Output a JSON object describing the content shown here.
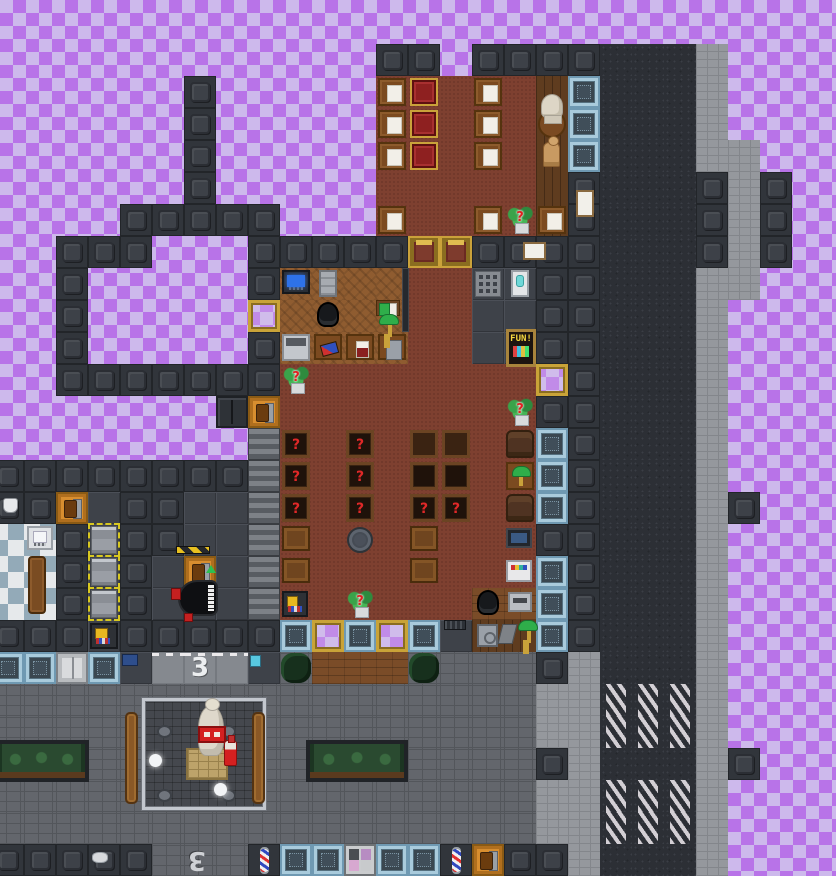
{
  "meta": {
    "description": "Top-down 2D space-station tile map (library, barbershop, statue plaza, road with crosswalks) over a purple transparency checkerboard",
    "grid": {
      "tile": 32,
      "cols": 27,
      "rows": 27,
      "offset_x": -8,
      "offset_y": 12
    }
  },
  "palette": {
    "checker_dark": "#b873e8",
    "checker_light": "#cdb9ec",
    "wall": "#31353b",
    "plating": "#3e4249",
    "red_floor": "#7e4030",
    "parquet": "#8f5c30",
    "porch": "#7a4c28",
    "sidewalk": "#95989d",
    "cobble": "#63666c",
    "asphalt": "#2c2f35",
    "crosswalk_stripe": "#d3cfd4",
    "window_frame_blue": "#a9cbdc",
    "gold": "#c9a23a",
    "airlock_orange": "#d88e2f",
    "question_red": "#e02020",
    "lamp_green": "#2fae4a",
    "barber_red": "#e03030",
    "barber_blue": "#3048c0"
  },
  "map": {
    "legend": {
      "#": {
        "cls": "wall",
        "name": "wall-tile",
        "inter": false
      },
      "Z": {
        "cls": "shutter",
        "name": "window-shutters",
        "inter": true
      },
      "R": {
        "cls": "redfloor",
        "name": "red-wood-floor",
        "inter": false
      },
      "P": {
        "cls": "parquet",
        "name": "parquet-floor",
        "inter": false
      },
      "H": {
        "cls": "woodv",
        "name": "dark-wood-floor",
        "inter": false
      },
      "p": {
        "cls": "porch",
        "name": "wood-deck-floor",
        "inter": false
      },
      "F": {
        "cls": "plating",
        "name": "plating-floor",
        "inter": false
      },
      "T": {
        "cls": "bath",
        "name": "checker-tile-floor",
        "inter": false
      },
      "S": {
        "cls": "side",
        "name": "sidewalk",
        "inter": false
      },
      "C": {
        "cls": "cobble",
        "name": "pavement",
        "inter": false
      },
      "A": {
        "cls": "asphalt",
        "name": "road",
        "inter": false
      },
      "X": {
        "cls": "cross",
        "name": "crosswalk",
        "inter": false
      },
      "L": {
        "cls": "lroad",
        "name": "road-lane",
        "inter": false
      },
      "B": {
        "cls": "bwin",
        "name": "reinforced-window",
        "inter": true
      },
      "G": {
        "cls": "gwin",
        "name": "gold-framed-window",
        "inter": true
      },
      "Y": {
        "cls": "ydoor",
        "name": "gold-glass-door",
        "inter": true
      },
      "O": {
        "cls": "odoor",
        "name": "orange-airlock",
        "inter": true
      },
      "W": {
        "cls": "wdoor",
        "name": "white-airlock",
        "inter": true
      },
      "d": {
        "cls": "ddoor",
        "name": "dark-double-door",
        "inter": true
      },
      "s": {
        "cls": "sdoor",
        "name": "salon-door",
        "inter": true
      },
      "b": {
        "cls": "barber",
        "name": "barber-pole-wall",
        "inter": false
      }
    },
    "rows": [
      "...........................",
      "............##.####AAAS....",
      "......#.....RRRRRHBAAAS....",
      "......#.....RRRRRHBAAAS....",
      "......#.....RRRRRHBAAASS...",
      "......#.....RRRRRH#AAA#S#..",
      "....#####...RRRRRH#AAA#S#..",
      "..###...#####YY####AAA#S#..",
      "..#.....#PPPPRRFF##AAASS...",
      "..#.....GPPPPRRFF##AAAS....",
      "..#.....#PPPPRRFF##AAAS....",
      "..#######RRRRRRRRG#AAAS....",
      ".......dORRRRRRRR##AAAS....",
      "........ZRRRRRRRRB#AAAS....",
      "########ZRRRRRRRRB#AAAS....",
      "##OF##FFZRRRRRRRRB#AAAS#...",
      "TT#F##FFZRRRRRRRR##AAAS....",
      "TT#F#FOFZRRRRRRRRB#AAAS....",
      "TT#F#FFFZRRRRRRppB#AAAS....",
      "###F#####BGBGBFHHB#AAAS....",
      "BBWBFLLLFCpppCCCC#SAAAS....",
      "CCCCCCCCCCCCCCCCCSSXXXS....",
      "CCCCCCCCCCCCCCCCCSSXXXS....",
      "CCCCCCCCCCCCCCCCC#SAAAS#...",
      "CCCCCCCCCCCCCCCCCSSXXXS....",
      "CCCCCCCCCCCCCCCCCSSXXXS....",
      "#####CCCbBBsBBbO##SAAAS...."
    ]
  },
  "objects": [
    {
      "type": "paper-table",
      "name": "table-with-paper",
      "col": 12,
      "row": 2
    },
    {
      "type": "paper-table",
      "name": "table-with-paper",
      "col": 12,
      "row": 3
    },
    {
      "type": "paper-table",
      "name": "table-with-paper",
      "col": 12,
      "row": 4
    },
    {
      "type": "paper-table",
      "name": "table-with-paper",
      "col": 15,
      "row": 2
    },
    {
      "type": "paper-table",
      "name": "table-with-paper",
      "col": 15,
      "row": 3
    },
    {
      "type": "paper-table",
      "name": "table-with-paper",
      "col": 15,
      "row": 4
    },
    {
      "type": "paper-table",
      "name": "table-with-paper",
      "col": 12,
      "row": 6
    },
    {
      "type": "paper-table",
      "name": "table-with-paper",
      "col": 15,
      "row": 6
    },
    {
      "type": "paper-table",
      "name": "table-with-paper",
      "col": 17,
      "row": 6
    },
    {
      "type": "chair-red",
      "name": "fancy-red-chair",
      "col": 13,
      "row": 2
    },
    {
      "type": "chair-red",
      "name": "fancy-red-chair",
      "col": 13,
      "row": 3
    },
    {
      "type": "chair-red",
      "name": "fancy-red-chair",
      "col": 13,
      "row": 4
    },
    {
      "type": "table-round",
      "name": "round-wood-table",
      "col": 17,
      "row": 3
    },
    {
      "type": "bust",
      "name": "statue-bust",
      "px": {
        "x": 541,
        "y": 94,
        "w": 22,
        "h": 24
      }
    },
    {
      "type": "mannequin",
      "name": "mannequin",
      "col": 17,
      "row": 4,
      "dx": 7,
      "w": 17,
      "h": 25
    },
    {
      "type": "sign",
      "name": "blank-poster",
      "inter": false,
      "px": {
        "x": 576,
        "y": 190,
        "w": 18,
        "h": 27
      }
    },
    {
      "type": "sign",
      "name": "blank-poster",
      "inter": false,
      "px": {
        "x": 523,
        "y": 242,
        "w": 23,
        "h": 18
      }
    },
    {
      "type": "plant",
      "name": "potted-plant-random",
      "label": "?",
      "col": 16,
      "row": 6
    },
    {
      "type": "plant",
      "name": "potted-plant-random",
      "label": "?",
      "col": 9,
      "row": 11
    },
    {
      "type": "plant",
      "name": "potted-plant-random",
      "label": "?",
      "col": 16,
      "row": 12
    },
    {
      "type": "plant",
      "name": "potted-plant-random",
      "label": "?",
      "col": 11,
      "row": 18
    },
    {
      "type": "shelf",
      "name": "bookshelf-random",
      "label": "?",
      "col": 9,
      "row": 13
    },
    {
      "type": "shelf",
      "name": "bookshelf-random",
      "label": "?",
      "col": 9,
      "row": 14
    },
    {
      "type": "shelf",
      "name": "bookshelf-random",
      "label": "?",
      "col": 9,
      "row": 15
    },
    {
      "type": "shelf",
      "name": "bookshelf-random",
      "label": "?",
      "col": 11,
      "row": 13
    },
    {
      "type": "shelf",
      "name": "bookshelf-random",
      "label": "?",
      "col": 11,
      "row": 14
    },
    {
      "type": "shelf",
      "name": "bookshelf-random",
      "label": "?",
      "col": 11,
      "row": 15
    },
    {
      "type": "shelf",
      "name": "bookshelf-random",
      "label": "?",
      "col": 13,
      "row": 15
    },
    {
      "type": "shelf",
      "name": "bookshelf-random",
      "label": "?",
      "col": 14,
      "row": 15
    },
    {
      "type": "shelf",
      "name": "bookshelf-empty",
      "col": 13,
      "row": 14
    },
    {
      "type": "shelf",
      "name": "bookshelf-empty",
      "col": 14,
      "row": 14
    },
    {
      "type": "table-dark",
      "name": "wood-table",
      "col": 13,
      "row": 13
    },
    {
      "type": "table-dark",
      "name": "wood-table",
      "col": 14,
      "row": 13
    },
    {
      "type": "crate",
      "name": "wood-crate-table",
      "col": 9,
      "row": 16,
      "h": 25
    },
    {
      "type": "crate",
      "name": "wood-crate-table",
      "col": 9,
      "row": 17,
      "h": 25
    },
    {
      "type": "crate",
      "name": "wood-crate-table",
      "col": 13,
      "row": 16,
      "h": 25
    },
    {
      "type": "crate",
      "name": "wood-crate-table",
      "col": 13,
      "row": 17,
      "h": 25
    },
    {
      "type": "manhole",
      "name": "floor-hatch",
      "col": 11,
      "row": 16,
      "w": 26,
      "h": 26,
      "dx": 3,
      "dy": 3
    },
    {
      "type": "armchair",
      "name": "armchair",
      "col": 16,
      "row": 13
    },
    {
      "type": "armchair",
      "name": "armchair",
      "col": 16,
      "row": 15
    },
    {
      "type": "lamp-table",
      "name": "table-with-banker-lamp",
      "col": 16,
      "row": 14
    },
    {
      "type": "tv",
      "name": "tv-console",
      "col": 16,
      "row": 16,
      "w": 26,
      "h": 20,
      "dy": 4
    },
    {
      "type": "booktagger",
      "name": "book-scanner-machine",
      "col": 16,
      "row": 17,
      "w": 26,
      "h": 22,
      "dy": 4
    },
    {
      "type": "printer",
      "name": "printer",
      "col": 16,
      "row": 18,
      "w": 24,
      "h": 20,
      "dx": 4,
      "dy": 4
    },
    {
      "type": "computer",
      "name": "computer-console",
      "col": 9,
      "row": 8,
      "h": 24
    },
    {
      "type": "cabinet",
      "name": "filing-cabinet",
      "col": 10,
      "row": 8,
      "w": 18,
      "h": 27,
      "dx": 7
    },
    {
      "type": "office-chair",
      "name": "office-chair",
      "col": 10,
      "row": 9,
      "w": 22,
      "h": 25,
      "dx": 5
    },
    {
      "type": "office-chair",
      "name": "office-chair",
      "col": 15,
      "row": 18,
      "w": 22,
      "h": 25,
      "dx": 5
    },
    {
      "type": "copier",
      "name": "copier-machine",
      "col": 9,
      "row": 10,
      "h": 27
    },
    {
      "type": "table-crayons",
      "name": "table-with-crayons",
      "col": 10,
      "row": 10,
      "h": 26
    },
    {
      "type": "table-bear",
      "name": "table-with-doll",
      "col": 11,
      "row": 10,
      "h": 26
    },
    {
      "type": "table-bin",
      "name": "table-with-bin",
      "col": 12,
      "row": 10,
      "h": 26
    },
    {
      "type": "bookstand",
      "name": "book-stand",
      "px": {
        "x": 376,
        "y": 300,
        "w": 24,
        "h": 16
      }
    },
    {
      "type": "banker-lamp",
      "name": "banker-lamp",
      "px": {
        "x": 379,
        "y": 314,
        "w": 20,
        "h": 11
      }
    },
    {
      "type": "railing",
      "name": "low-wall",
      "inter": false,
      "px": {
        "x": 402,
        "y": 268,
        "w": 7,
        "h": 64
      }
    },
    {
      "type": "grille",
      "name": "floor-grille",
      "col": 15,
      "row": 8,
      "w": 26,
      "h": 26,
      "dx": 3,
      "dy": 3
    },
    {
      "type": "cooler",
      "name": "water-cooler",
      "col": 16,
      "row": 8,
      "w": 18,
      "h": 27,
      "dx": 7
    },
    {
      "type": "vending",
      "name": "vending-machine-fun",
      "label": "FUN!",
      "px": {
        "x": 506,
        "y": 329,
        "w": 30,
        "h": 38
      }
    },
    {
      "type": "safe",
      "name": "safe",
      "col": 15,
      "row": 19,
      "w": 21,
      "h": 23,
      "dx": 5,
      "dy": 4
    },
    {
      "type": "scanner",
      "name": "hand-scanner",
      "px": {
        "x": 500,
        "y": 624,
        "w": 15,
        "h": 20
      }
    },
    {
      "type": "banker-lamp",
      "name": "banker-lamp",
      "px": {
        "x": 518,
        "y": 620,
        "w": 20,
        "h": 11
      }
    },
    {
      "type": "vent",
      "name": "floor-vent",
      "inter": false,
      "px": {
        "x": 444,
        "y": 620,
        "w": 22,
        "h": 10
      }
    },
    {
      "type": "piano",
      "name": "grand-piano",
      "px": {
        "x": 178,
        "y": 580,
        "w": 40,
        "h": 36
      }
    },
    {
      "type": "caution",
      "name": "hazard-stripe",
      "inter": false,
      "px": {
        "x": 176,
        "y": 546,
        "w": 34,
        "h": 8
      }
    },
    {
      "type": "reditem",
      "name": "red-book",
      "px": {
        "x": 171,
        "y": 588,
        "w": 10,
        "h": 12
      }
    },
    {
      "type": "reditem",
      "name": "red-item",
      "px": {
        "x": 184,
        "y": 613,
        "w": 9,
        "h": 9
      }
    },
    {
      "type": "arrow-green",
      "name": "status-arrow",
      "inter": false,
      "px": {
        "x": 206,
        "y": 565,
        "w": 10,
        "h": 8
      }
    },
    {
      "type": "rack",
      "name": "storage-rack",
      "col": 3,
      "row": 16,
      "w": 26,
      "h": 28,
      "dx": 3
    },
    {
      "type": "rack",
      "name": "storage-rack",
      "col": 3,
      "row": 17,
      "w": 26,
      "h": 28,
      "dx": 3
    },
    {
      "type": "rack",
      "name": "storage-rack",
      "col": 3,
      "row": 18,
      "w": 26,
      "h": 28,
      "dx": 3
    },
    {
      "type": "machine-yellow",
      "name": "redemption-machine",
      "col": 3,
      "row": 19,
      "w": 28,
      "h": 26,
      "dy": 3
    },
    {
      "type": "machine-yellow",
      "name": "redemption-machine",
      "col": 9,
      "row": 18,
      "w": 26,
      "h": 26,
      "dy": 3
    },
    {
      "type": "bath-console",
      "name": "wall-console",
      "col": 1,
      "row": 16,
      "w": 26,
      "h": 24,
      "dx": 3
    },
    {
      "type": "wood-locker",
      "name": "wooden-locker",
      "px": {
        "x": 28,
        "y": 556,
        "w": 18,
        "h": 58
      }
    },
    {
      "type": "sink-icon",
      "name": "sink-icon",
      "inter": false,
      "px": {
        "x": 3,
        "y": 498,
        "w": 15,
        "h": 15
      }
    },
    {
      "type": "dish-icon",
      "name": "dish-icon",
      "inter": false,
      "px": {
        "x": 92,
        "y": 852,
        "w": 16,
        "h": 11
      }
    },
    {
      "type": "crate-blue",
      "name": "blue-crate",
      "px": {
        "x": 122,
        "y": 654,
        "w": 16,
        "h": 12
      }
    },
    {
      "type": "icon-blue2",
      "name": "small-blue-item",
      "px": {
        "x": 250,
        "y": 655,
        "w": 11,
        "h": 12
      }
    },
    {
      "type": "bush",
      "name": "hedge-bush",
      "inter": false,
      "col": 9,
      "row": 20,
      "w": 30,
      "h": 30,
      "dx": 1,
      "dy": 1
    },
    {
      "type": "bush",
      "name": "hedge-bush",
      "inter": false,
      "col": 13,
      "row": 20,
      "w": 30,
      "h": 30,
      "dx": 1,
      "dy": 1
    },
    {
      "type": "planter",
      "name": "planter-box",
      "inter": false,
      "px": {
        "x": -6,
        "y": 740,
        "w": 95,
        "h": 42
      }
    },
    {
      "type": "planter",
      "name": "planter-box",
      "inter": false,
      "px": {
        "x": 306,
        "y": 740,
        "w": 102,
        "h": 42
      }
    },
    {
      "type": "enclosure",
      "name": "statue-fence-enclosure",
      "inter": false,
      "px": {
        "x": 142,
        "y": 698,
        "w": 124,
        "h": 112
      }
    },
    {
      "type": "hatch",
      "name": "ground-hatch",
      "inter": false,
      "px": {
        "x": 157,
        "y": 725,
        "w": 15,
        "h": 13
      }
    },
    {
      "type": "hatch",
      "name": "ground-hatch",
      "inter": false,
      "px": {
        "x": 221,
        "y": 725,
        "w": 15,
        "h": 13
      }
    },
    {
      "type": "hatch",
      "name": "ground-hatch",
      "inter": false,
      "px": {
        "x": 157,
        "y": 789,
        "w": 15,
        "h": 13
      }
    },
    {
      "type": "hatch",
      "name": "ground-hatch",
      "inter": false,
      "px": {
        "x": 221,
        "y": 789,
        "w": 15,
        "h": 13
      }
    },
    {
      "type": "orb",
      "name": "light-orb",
      "inter": false,
      "px": {
        "x": 149,
        "y": 754,
        "w": 13,
        "h": 13
      }
    },
    {
      "type": "orb",
      "name": "light-orb",
      "inter": false,
      "px": {
        "x": 214,
        "y": 783,
        "w": 13,
        "h": 13
      }
    },
    {
      "type": "pedestal",
      "name": "brick-pedestal",
      "inter": false,
      "px": {
        "x": 186,
        "y": 748,
        "w": 42,
        "h": 32
      }
    },
    {
      "type": "statue",
      "name": "marble-statue",
      "px": {
        "x": 198,
        "y": 706,
        "w": 26,
        "h": 50
      }
    },
    {
      "type": "red-sign",
      "name": "red-banner",
      "px": {
        "x": 198,
        "y": 726,
        "w": 28,
        "h": 17
      }
    },
    {
      "type": "bottle",
      "name": "red-bottle",
      "px": {
        "x": 224,
        "y": 740,
        "w": 13,
        "h": 26
      }
    },
    {
      "type": "door-wood",
      "name": "wooden-gate",
      "px": {
        "x": 125,
        "y": 712,
        "w": 13,
        "h": 92
      }
    },
    {
      "type": "door-wood",
      "name": "wooden-gate",
      "px": {
        "x": 252,
        "y": 712,
        "w": 13,
        "h": 92
      }
    },
    {
      "type": "mark3",
      "name": "road-marking-3",
      "label": "3",
      "inter": false,
      "col": 6,
      "row": 20,
      "w": 24,
      "h": 30,
      "dx": 4,
      "dy": 1
    },
    {
      "type": "mark3",
      "name": "road-marking-3-flipped",
      "label": "3",
      "flip": true,
      "inter": false,
      "px": {
        "x": 184,
        "y": 845,
        "w": 26,
        "h": 30
      }
    }
  ]
}
